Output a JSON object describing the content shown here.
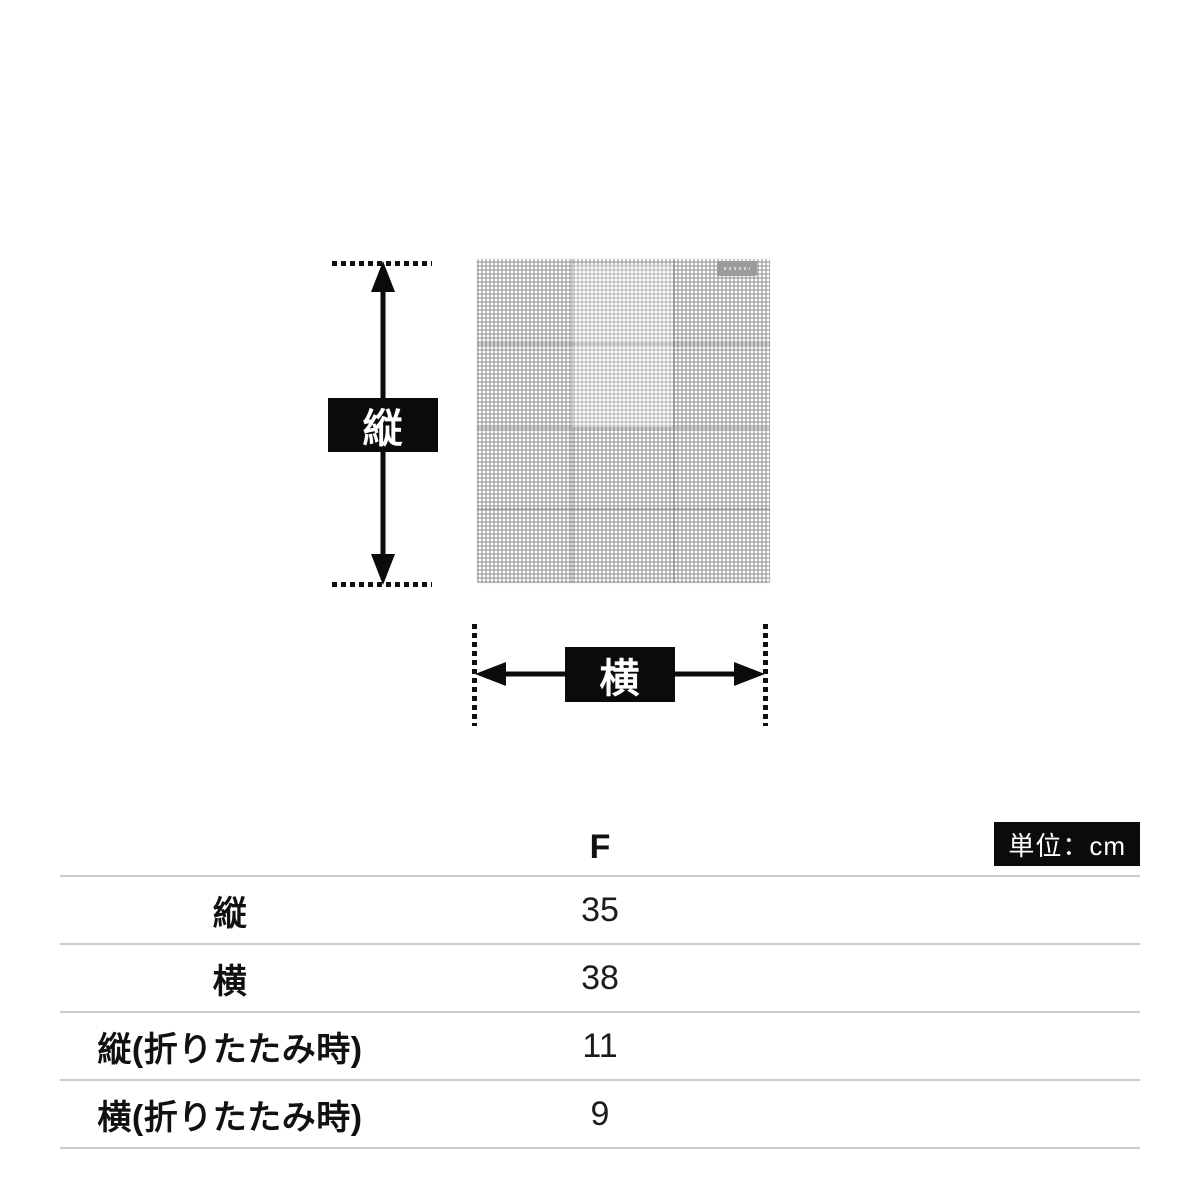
{
  "diagram": {
    "vertical_label": "縦",
    "horizontal_label": "横"
  },
  "table": {
    "column_header": "F",
    "unit_label": "単位：cm",
    "rows": [
      {
        "label": "縦",
        "value": "35"
      },
      {
        "label": "横",
        "value": "38"
      },
      {
        "label": "縦(折りたたみ時)",
        "value": "11"
      },
      {
        "label": "横(折りたたみ時)",
        "value": "9"
      }
    ]
  },
  "colors": {
    "accent_black": "#0b0b0b",
    "table_line_gray": "#cbcbcb",
    "gingham_gray": "#7a7a7a",
    "tag_gray": "#9b9b9b",
    "background": "#ffffff"
  }
}
